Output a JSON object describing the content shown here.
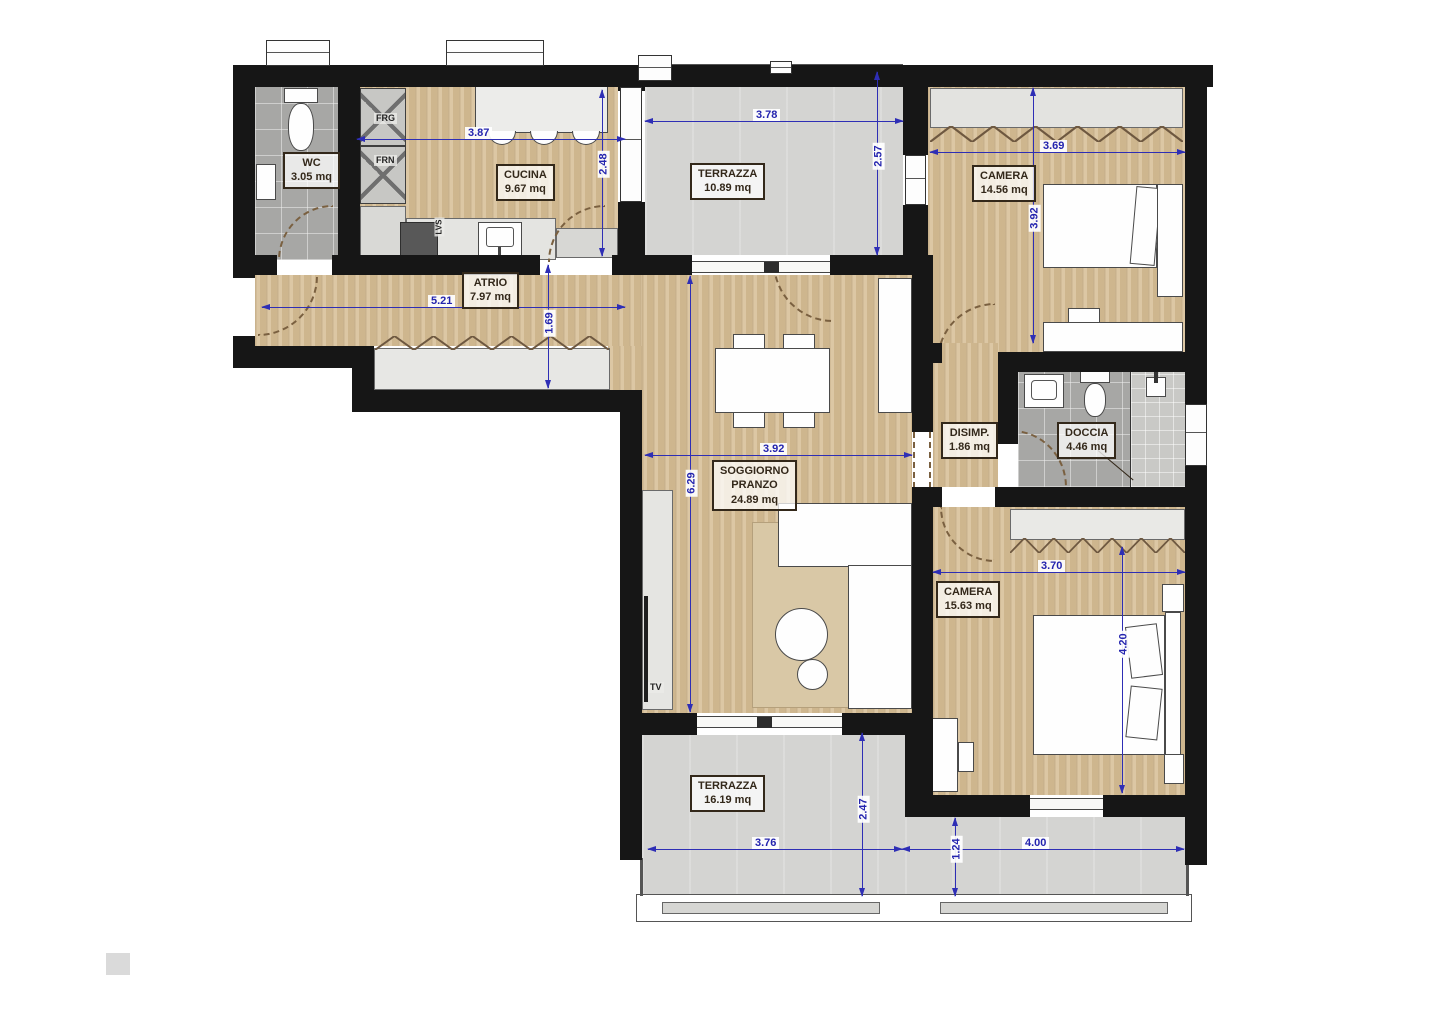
{
  "rooms": {
    "wc": {
      "name": "WC",
      "area": "3.05 mq"
    },
    "cucina": {
      "name": "CUCINA",
      "area": "9.67 mq"
    },
    "atrio": {
      "name": "ATRIO",
      "area": "7.97 mq"
    },
    "terrazza_nord": {
      "name": "TERRAZZA",
      "area": "10.89 mq"
    },
    "camera_nord": {
      "name": "CAMERA",
      "area": "14.56 mq"
    },
    "soggiorno": {
      "line1": "SOGGIORNO",
      "line2": "PRANZO",
      "area": "24.89 mq"
    },
    "disimpegno": {
      "name": "DISIMP.",
      "area": "1.86 mq"
    },
    "doccia": {
      "name": "DOCCIA",
      "area": "4.46 mq"
    },
    "camera_sud": {
      "name": "CAMERA",
      "area": "15.63 mq"
    },
    "terrazza_sud": {
      "name": "TERRAZZA",
      "area": "16.19 mq"
    }
  },
  "appliances": {
    "fridge": "FRG",
    "oven": "FRN",
    "dishwasher": "LVS",
    "tv": "TV"
  },
  "dimensions_m": {
    "cucina_width": "3.87",
    "cucina_depth": "2.48",
    "terrazza_nord_width": "3.78",
    "terrazza_nord_depth": "2.57",
    "camera_nord_width": "3.69",
    "camera_nord_depth": "3.92",
    "atrio_width": "5.21",
    "atrio_depth": "1.69",
    "soggiorno_width": "3.92",
    "soggiorno_depth": "6.29",
    "camera_sud_width": "3.70",
    "camera_sud_depth": "4.20",
    "terrazza_sud_width": "3.76",
    "terrazza_sud_depth": "2.47",
    "terrazza_sud_right_width": "4.00",
    "terrazza_sud_right_depth": "1.24"
  },
  "colors": {
    "wall": "#161616",
    "wood_floor": "#d7bf96",
    "bath_tile": "#a7a7a5",
    "terrace_floor": "#d4d4d2",
    "dimension_blue": "#2e2eb5",
    "label_ink": "#33281a"
  }
}
